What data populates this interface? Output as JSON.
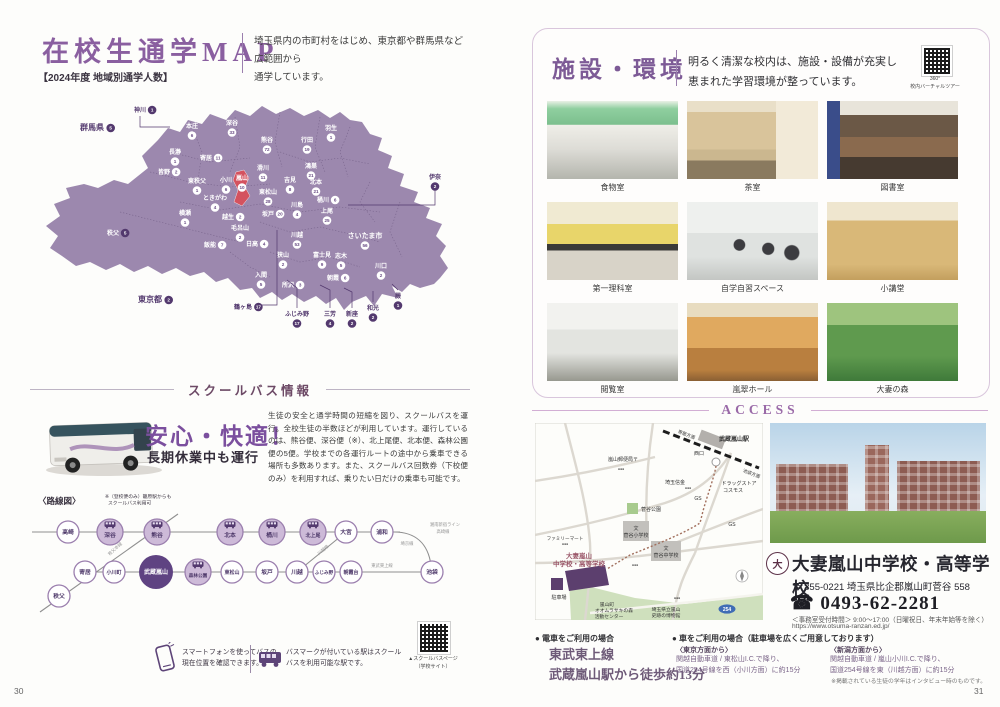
{
  "page_left": {
    "page_number": "30",
    "title": "在校生通学MAP",
    "intro1": "埼玉県内の市町村をはじめ、東京都や群馬県など広範囲から",
    "intro2": "通学しています。",
    "subtitle": "【2024年度 地域別通学人数】",
    "map": {
      "regions": [
        {
          "name": "群馬県",
          "count": 5,
          "x": 62,
          "y": 38,
          "style": "out",
          "fs": 8,
          "badge": "r"
        },
        {
          "name": "神川",
          "count": 1,
          "x": 110,
          "y": 20,
          "style": "out",
          "badge": "r",
          "line": [
            [
              110,
              24
            ],
            [
              110,
              35
            ],
            [
              140,
              35
            ]
          ]
        },
        {
          "name": "本庄",
          "count": 6,
          "x": 162,
          "y": 36,
          "style": "in"
        },
        {
          "name": "深谷",
          "count": 33,
          "x": 202,
          "y": 33,
          "style": "in"
        },
        {
          "name": "熊谷",
          "count": 72,
          "x": 237,
          "y": 50,
          "style": "in"
        },
        {
          "name": "行田",
          "count": 19,
          "x": 277,
          "y": 50,
          "style": "in"
        },
        {
          "name": "羽生",
          "count": 1,
          "x": 301,
          "y": 38,
          "style": "in"
        },
        {
          "name": "鴻巣",
          "count": 21,
          "x": 281,
          "y": 76,
          "style": "in"
        },
        {
          "name": "長瀞",
          "count": 1,
          "x": 145,
          "y": 62,
          "style": "in"
        },
        {
          "name": "寄居",
          "count": 11,
          "x": 176,
          "y": 68,
          "style": "in",
          "badge": "r"
        },
        {
          "name": "皆野",
          "count": 2,
          "x": 134,
          "y": 82,
          "style": "in",
          "badge": "r"
        },
        {
          "name": "東秩父",
          "count": 1,
          "x": 167,
          "y": 91,
          "style": "in"
        },
        {
          "name": "小川",
          "count": 6,
          "x": 196,
          "y": 90,
          "style": "in"
        },
        {
          "name": "嵐山",
          "count": 10,
          "x": 212,
          "y": 88,
          "style": "in"
        },
        {
          "name": "滑川",
          "count": 11,
          "x": 233,
          "y": 78,
          "style": "in"
        },
        {
          "name": "吉見",
          "count": 8,
          "x": 260,
          "y": 90,
          "style": "in"
        },
        {
          "name": "北本",
          "count": 21,
          "x": 286,
          "y": 92,
          "style": "in"
        },
        {
          "name": "桶川",
          "count": 6,
          "x": 293,
          "y": 110,
          "style": "in",
          "badge": "r"
        },
        {
          "name": "上尾",
          "count": 25,
          "x": 297,
          "y": 121,
          "style": "in"
        },
        {
          "name": "東松山",
          "count": 28,
          "x": 238,
          "y": 102,
          "style": "in"
        },
        {
          "name": "川島",
          "count": 4,
          "x": 267,
          "y": 115,
          "style": "in"
        },
        {
          "name": "ときがわ",
          "count": 4,
          "x": 185,
          "y": 108,
          "style": "in"
        },
        {
          "name": "横瀬",
          "count": 1,
          "x": 155,
          "y": 123,
          "style": "in"
        },
        {
          "name": "越生",
          "count": 2,
          "x": 198,
          "y": 127,
          "style": "in",
          "badge": "r"
        },
        {
          "name": "毛呂山",
          "count": 2,
          "x": 210,
          "y": 138,
          "style": "in"
        },
        {
          "name": "坂戸",
          "count": 20,
          "x": 238,
          "y": 124,
          "style": "in",
          "badge": "r"
        },
        {
          "name": "川越",
          "count": 53,
          "x": 267,
          "y": 145,
          "style": "in"
        },
        {
          "name": "さいたま市",
          "count": 56,
          "x": 335,
          "y": 146,
          "style": "in",
          "fs": 7
        },
        {
          "name": "秩父",
          "count": 5,
          "x": 83,
          "y": 143,
          "style": "in",
          "dark": true,
          "badge": "r"
        },
        {
          "name": "飯能",
          "count": 7,
          "x": 180,
          "y": 155,
          "style": "in",
          "badge": "r"
        },
        {
          "name": "日高",
          "count": 4,
          "x": 222,
          "y": 154,
          "style": "in",
          "badge": "r"
        },
        {
          "name": "狭山",
          "count": 2,
          "x": 253,
          "y": 165,
          "style": "in"
        },
        {
          "name": "入間",
          "count": 5,
          "x": 231,
          "y": 185,
          "style": "in"
        },
        {
          "name": "所沢",
          "count": 3,
          "x": 258,
          "y": 195,
          "style": "in",
          "badge": "r"
        },
        {
          "name": "富士見",
          "count": 9,
          "x": 292,
          "y": 165,
          "style": "in"
        },
        {
          "name": "志木",
          "count": 5,
          "x": 311,
          "y": 166,
          "style": "in"
        },
        {
          "name": "朝霞",
          "count": 6,
          "x": 303,
          "y": 188,
          "style": "in",
          "badge": "r"
        },
        {
          "name": "川口",
          "count": 2,
          "x": 351,
          "y": 176,
          "style": "in"
        },
        {
          "name": "伊奈",
          "count": 2,
          "x": 405,
          "y": 87,
          "style": "out",
          "line": [
            [
              405,
              98
            ],
            [
              405,
              113
            ],
            [
              318,
              113
            ]
          ]
        },
        {
          "name": "東京都",
          "count": 2,
          "x": 120,
          "y": 210,
          "style": "out",
          "fs": 8,
          "badge": "r"
        },
        {
          "name": "鶴ヶ島",
          "count": 17,
          "x": 213,
          "y": 217,
          "style": "out",
          "badge": "r",
          "line": [
            [
              232,
              213
            ],
            [
              247,
              213
            ],
            [
              247,
              138
            ]
          ]
        },
        {
          "name": "ふじみ野",
          "count": 17,
          "x": 267,
          "y": 224,
          "style": "out",
          "line": [
            [
              267,
              216
            ],
            [
              267,
              196
            ],
            [
              257,
              188
            ]
          ]
        },
        {
          "name": "三芳",
          "count": 4,
          "x": 300,
          "y": 224,
          "style": "out",
          "line": [
            [
              300,
              216
            ],
            [
              300,
              198
            ],
            [
              290,
              193
            ]
          ]
        },
        {
          "name": "新座",
          "count": 2,
          "x": 322,
          "y": 224,
          "style": "out",
          "line": [
            [
              322,
              216
            ],
            [
              322,
              200
            ],
            [
              314,
              196
            ]
          ]
        },
        {
          "name": "和光",
          "count": 2,
          "x": 343,
          "y": 218,
          "style": "out",
          "line": [
            [
              343,
              210
            ],
            [
              343,
              199
            ]
          ]
        },
        {
          "name": "蕨",
          "count": 1,
          "x": 368,
          "y": 206,
          "style": "out",
          "line": [
            [
              368,
              198
            ],
            [
              362,
              192
            ]
          ]
        }
      ]
    },
    "bus_section": {
      "heading": "スクールバス情報",
      "catch": "安心・快適！",
      "subcatch": "長期休業中も運行",
      "body": "生徒の安全と通学時間の短縮を図り、スクールバスを運行。全校生徒の半数ほどが利用しています。運行しているのは、熊谷便、深谷便（※）、北上尾便、北本便、森林公園便の5便。学校までの各運行ルートの途中から乗車できる場所も多数あります。また、スクールバス回数券（下校便のみ）を利用すれば、乗りたい日だけの乗車も可能です。"
    },
    "route": {
      "heading": "〈路線図〉",
      "note1": "※（登校便のみ）籠原駅からも",
      "note2": "スクールバス利用可",
      "top": [
        {
          "n": "高崎",
          "x": 38
        },
        {
          "n": "深谷",
          "x": 80,
          "bus": 1
        },
        {
          "n": "熊谷",
          "x": 127,
          "bus": 1
        },
        {
          "n": "北本",
          "x": 200,
          "bus": 1
        },
        {
          "n": "桶川",
          "x": 242,
          "bus": 1
        },
        {
          "n": "北上尾",
          "x": 283,
          "bus": 1
        },
        {
          "n": "大宮",
          "x": 316
        },
        {
          "n": "浦和",
          "x": 352
        }
      ],
      "bottom": [
        {
          "n": "秩父",
          "x": 29,
          "y": 108
        },
        {
          "n": "寄居",
          "x": 55
        },
        {
          "n": "小川町",
          "x": 84
        },
        {
          "n": "武蔵嵐山",
          "x": 126,
          "main": 1
        },
        {
          "n": "森林公園",
          "x": 168,
          "bus": 1
        },
        {
          "n": "東松山",
          "x": 202
        },
        {
          "n": "坂戸",
          "x": 237
        },
        {
          "n": "川越",
          "x": 267
        },
        {
          "n": "ふじみ野",
          "x": 294
        },
        {
          "n": "朝霞台",
          "x": 321
        },
        {
          "n": "池袋",
          "x": 402
        }
      ],
      "labels": [
        {
          "t": "秩父本線",
          "x": 86,
          "y": 62,
          "r": -42
        },
        {
          "t": "川越線",
          "x": 294,
          "y": 63,
          "r": -40
        },
        {
          "t": "埼京線",
          "x": 377,
          "y": 57
        },
        {
          "t": "湘南新宿ライン",
          "x": 415,
          "y": 38
        },
        {
          "t": "高崎線",
          "x": 413,
          "y": 45
        },
        {
          "t": "東武東上線",
          "x": 352,
          "y": 79
        }
      ]
    },
    "footnotes": {
      "smartphone": "スマートフォンを使ってバスの現在位置を確認できます。",
      "busmark": "バスマークが付いている駅はスクールバスを利用可能な駅です。",
      "qr_caption1": "▲スクールバスページ",
      "qr_caption2": "（学校サイト）"
    }
  },
  "page_right": {
    "page_number": "31",
    "facility": {
      "title": "施設・環境",
      "lead1": "明るく清潔な校内は、施設・設備が充実し",
      "lead2": "恵まれた学習環境が整っています。",
      "qr_caption1": "360°",
      "qr_caption2": "校内バーチャルツアー",
      "photos": [
        {
          "caption": "食物室"
        },
        {
          "caption": "茶室"
        },
        {
          "caption": "図書室"
        },
        {
          "caption": "第一理科室"
        },
        {
          "caption": "自学自習スペース"
        },
        {
          "caption": "小講堂"
        },
        {
          "caption": "閲覧室"
        },
        {
          "caption": "嵐翠ホール"
        },
        {
          "caption": "大妻の森"
        }
      ]
    },
    "access": {
      "title": "ACCESS",
      "map_labels": [
        {
          "t": "寄居方面",
          "x": 151,
          "y": 13,
          "rot": 21,
          "s": 4.5
        },
        {
          "t": "武蔵嵐山駅",
          "x": 199,
          "y": 18,
          "s": 6,
          "b": 1
        },
        {
          "t": "西口",
          "x": 164,
          "y": 32,
          "s": 5
        },
        {
          "t": "池袋方面",
          "x": 216,
          "y": 52,
          "rot": 21,
          "s": 4.5
        },
        {
          "t": "嵐山郵便局〒",
          "x": 88,
          "y": 38,
          "s": 5
        },
        {
          "t": "●●●",
          "x": 86,
          "y": 47,
          "s": 3.5
        },
        {
          "t": "埼玉信金",
          "x": 140,
          "y": 61,
          "s": 5
        },
        {
          "t": "●●●",
          "x": 153,
          "y": 66,
          "s": 3.5
        },
        {
          "t": "ドラッグストア",
          "x": 204,
          "y": 62,
          "s": 5
        },
        {
          "t": "コスモス",
          "x": 198,
          "y": 69,
          "s": 5
        },
        {
          "t": "GS",
          "x": 163,
          "y": 77,
          "s": 5
        },
        {
          "t": "GS",
          "x": 197,
          "y": 103,
          "s": 5
        },
        {
          "t": "菅谷公園",
          "x": 116,
          "y": 88,
          "s": 5
        },
        {
          "t": "文",
          "x": 101,
          "y": 107,
          "s": 5
        },
        {
          "t": "菅谷小学校",
          "x": 101,
          "y": 114,
          "s": 5
        },
        {
          "t": "文",
          "x": 131,
          "y": 127,
          "s": 5
        },
        {
          "t": "菅谷中学校",
          "x": 131,
          "y": 134,
          "s": 5
        },
        {
          "t": "ファミリーマート",
          "x": 30,
          "y": 117,
          "s": 4.6
        },
        {
          "t": "●●●",
          "x": 30,
          "y": 122,
          "s": 3.5
        },
        {
          "t": "大妻嵐山",
          "x": 44,
          "y": 135,
          "s": 6.5,
          "red": 1
        },
        {
          "t": "中学校・高等学校",
          "x": 44,
          "y": 143,
          "s": 6.5,
          "red": 1
        },
        {
          "t": "●●●",
          "x": 100,
          "y": 143,
          "s": 3.5
        },
        {
          "t": "駐車場",
          "x": 24,
          "y": 176,
          "s": 5
        },
        {
          "t": "嵐山町",
          "x": 72,
          "y": 183,
          "s": 4.8
        },
        {
          "t": "オオムラサキの森",
          "x": 79,
          "y": 189,
          "s": 4.8
        },
        {
          "t": "活動センター",
          "x": 74,
          "y": 195,
          "s": 4.8
        },
        {
          "t": "●●●",
          "x": 142,
          "y": 176,
          "s": 3.5
        },
        {
          "t": "埼玉県立嵐山",
          "x": 131,
          "y": 188,
          "s": 4.8
        },
        {
          "t": "史跡の博物館",
          "x": 131,
          "y": 194,
          "s": 4.8
        },
        {
          "t": "254",
          "x": 192,
          "y": 188,
          "s": 5,
          "badge": 1
        }
      ],
      "logo_glyph": "大",
      "school_name": "大妻嵐山中学校・高等学校",
      "address": "〒 355-0221  埼玉県比企郡嵐山町菅谷 558",
      "tel": "☎ 0493-62-2281",
      "hours": "＜事務室受付時間＞ 9:00～17:00（日曜祝日、年末年始等を除く）",
      "url": "https://www.otsuma-ranzan.ed.jp/",
      "train_heading": "● 電車をご利用の場合",
      "train_line1": "東武東上線",
      "train_line2": "武蔵嵐山駅から徒歩約13分",
      "car_heading": "● 車をご利用の場合（駐車場を広くご用意しております）",
      "car_tokyo_label": "〈東京方面から〉",
      "car_tokyo1": "関越自動車道 / 東松山I.C.で降り、",
      "car_tokyo2": "国道254号線を西（小川方面）に約15分",
      "car_niigata_label": "〈新潟方面から〉",
      "car_niigata1": "関越自動車道 / 嵐山小川I.C.で降り、",
      "car_niigata2": "国道254号線を東（川越方面）に約15分",
      "footnote": "※掲載されている生徒の学年はインタビュー時のものです。"
    }
  }
}
